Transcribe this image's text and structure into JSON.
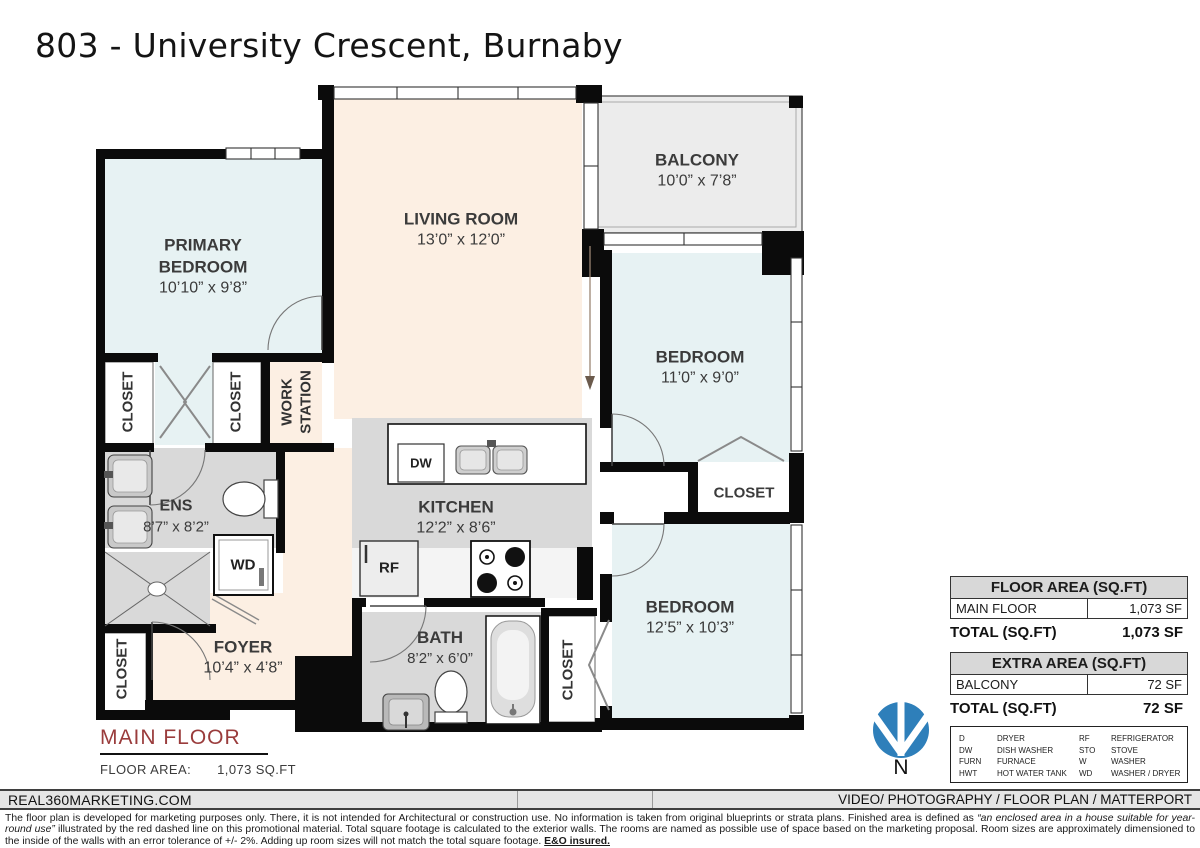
{
  "title": "803 - University Crescent, Burnaby",
  "rooms": {
    "primary_bedroom": {
      "name": "PRIMARY BEDROOM",
      "dims": "10’10” x 9’8”"
    },
    "living_room": {
      "name": "LIVING ROOM",
      "dims": "13’0” x 12’0”"
    },
    "balcony": {
      "name": "BALCONY",
      "dims": "10’0” x 7’8”"
    },
    "bedroom_top": {
      "name": "BEDROOM",
      "dims": "11’0” x 9’0”"
    },
    "bedroom_bottom": {
      "name": "BEDROOM",
      "dims": "12’5” x 10’3”"
    },
    "kitchen": {
      "name": "KITCHEN",
      "dims": "12’2” x 8’6”"
    },
    "ensuite": {
      "name": "ENS",
      "dims": "8’7” x 8’2”"
    },
    "foyer": {
      "name": "FOYER",
      "dims": "10’4” x 4’8”"
    },
    "bath": {
      "name": "BATH",
      "dims": "8’2” x 6’0”"
    },
    "closet": "CLOSET",
    "work_station": "WORK\nSTATION"
  },
  "fixtures": {
    "dw": "DW",
    "wd": "WD",
    "rf": "RF"
  },
  "floor_label": {
    "name": "MAIN FLOOR",
    "area_label": "FLOOR AREA:",
    "area_value": "1,073 SQ.FT"
  },
  "tables": {
    "floor": {
      "header": "FLOOR AREA (SQ.FT)",
      "rows": [
        [
          "MAIN FLOOR",
          "1,073 SF"
        ]
      ],
      "total_label": "TOTAL (SQ.FT)",
      "total_value": "1,073 SF"
    },
    "extra": {
      "header": "EXTRA AREA (SQ.FT)",
      "rows": [
        [
          "BALCONY",
          "72 SF"
        ]
      ],
      "total_label": "TOTAL (SQ.FT)",
      "total_value": "72 SF"
    }
  },
  "legend": [
    {
      "abbr": "D",
      "label": "DRYER"
    },
    {
      "abbr": "DW",
      "label": "DISH WASHER"
    },
    {
      "abbr": "FURN",
      "label": "FURNACE"
    },
    {
      "abbr": "HWT",
      "label": "HOT WATER TANK"
    },
    {
      "abbr": "RF",
      "label": "REFRIGERATOR"
    },
    {
      "abbr": "STO",
      "label": "STOVE"
    },
    {
      "abbr": "W",
      "label": "WASHER"
    },
    {
      "abbr": "WD",
      "label": "WASHER / DRYER"
    }
  ],
  "compass": {
    "label": "N"
  },
  "footer": {
    "left": "REAL360MARKETING.COM",
    "right": "VIDEO/ PHOTOGRAPHY / FLOOR PLAN / MATTERPORT"
  },
  "disclaimer": {
    "p1": "The floor plan is developed for marketing purposes only. There, it is not intended for Architectural or construction use. No information is taken from original blueprints or strata plans. Finished area is defined as ",
    "italic": "“an enclosed area in a house suitable for year-round use”",
    "p2": " illustrated by the red dashed line on this promotional material. Total square footage is calculated to the exterior walls. The rooms are named as possible use of space based on the marketing proposal. Room sizes are approximately dimensioned to the inside of the walls with an error tolerance of +/- 2%. Adding up room sizes will not match the total square footage. ",
    "bold": "E&O insured."
  },
  "colors": {
    "bedroom": "#e7f2f3",
    "living": "#fcefe3",
    "wet": "#d9d9d9",
    "balcony": "#ececec",
    "accent_red": "#9a3c3c",
    "compass_blue": "#2e7fba"
  }
}
